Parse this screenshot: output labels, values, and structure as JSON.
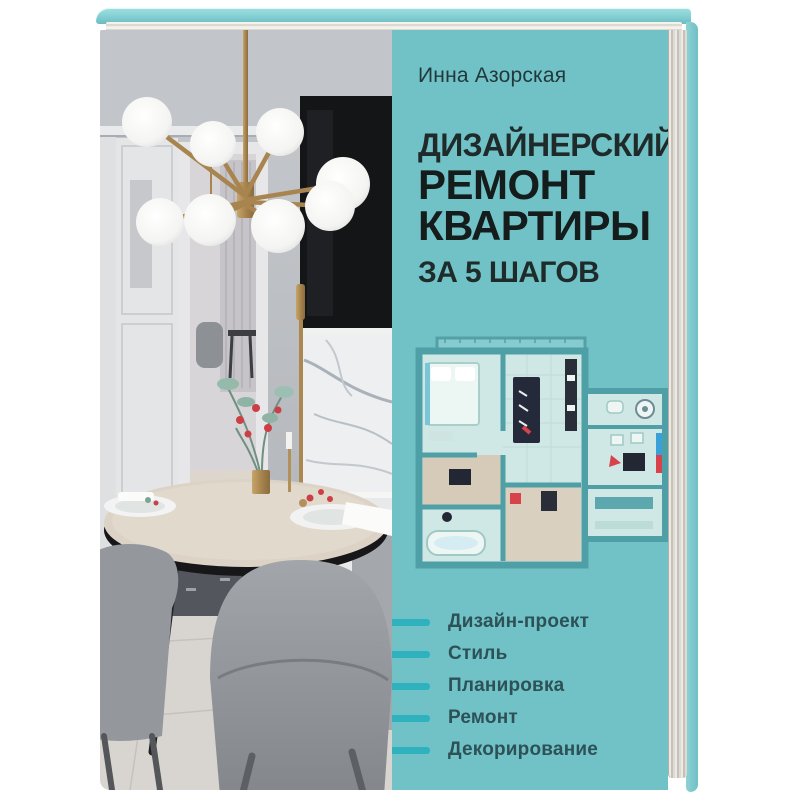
{
  "cover": {
    "author": "Инна Азорская",
    "title_lines": [
      "ДИЗАЙНЕРСКИЙ",
      "РЕМОНТ",
      "КВАРТИРЫ",
      "ЗА 5 ШАГОВ"
    ],
    "features": [
      "Дизайн-проект",
      "Стиль",
      "Планировка",
      "Ремонт",
      "Декорирование"
    ]
  },
  "colors": {
    "cover_teal": "#71c2c7",
    "cover_teal_top": "#8ad4d7",
    "feature_dash_teal": "#2fb2bd",
    "title_color": "#1a2423",
    "author_color": "#21393c",
    "feature_text_color": "#2c5157",
    "background": "#ffffff"
  }
}
